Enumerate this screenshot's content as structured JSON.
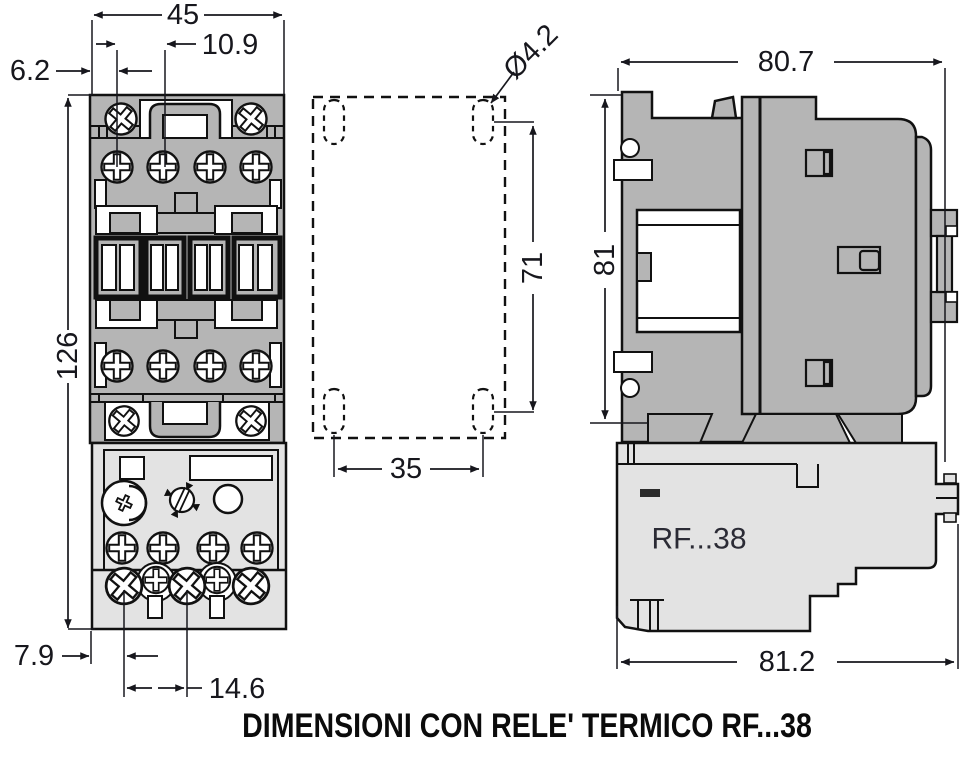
{
  "caption": "DIMENSIONI CON RELE' TERMICO RF...38",
  "colors": {
    "contactor_fill": "#b5b5b5",
    "relay_fill": "#e3e3e3",
    "line": "#111111",
    "dim_text": "#17171d"
  },
  "front_view": {
    "dims": {
      "overall_width": "45",
      "terminal_pitch": "10.9",
      "left_offset": "6.2",
      "overall_height": "126",
      "foot_offset": "7.9",
      "relay_terminal_pitch": "14.6"
    }
  },
  "drilling_plan": {
    "dims": {
      "hole_diameter": "Ø4.2",
      "vertical_pitch": "71",
      "horizontal_pitch": "35"
    }
  },
  "side_view": {
    "relay_label": "RF...38",
    "dims": {
      "width": "80.7",
      "height": "81",
      "width_with_relay": "81.2"
    }
  }
}
